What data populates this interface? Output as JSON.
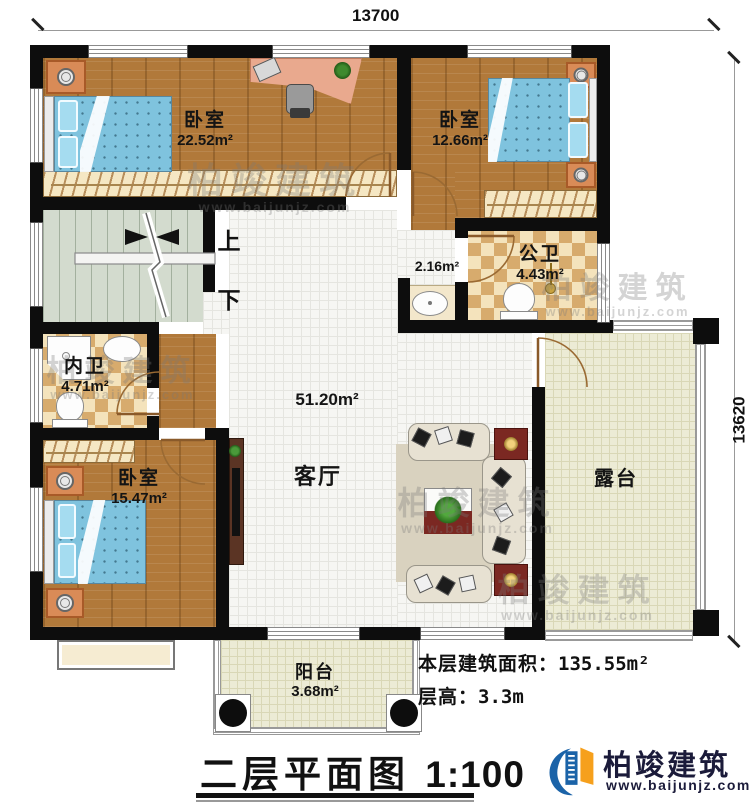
{
  "dimensions": {
    "top_width": "13700",
    "right_height": "13620"
  },
  "rooms": {
    "bedroom_top_left": {
      "name": "卧室",
      "area": "22.52m²"
    },
    "bedroom_top_right": {
      "name": "卧室",
      "area": "12.66m²"
    },
    "public_bathroom": {
      "name": "公卫",
      "area": "4.43m²"
    },
    "wash_area": {
      "area": "2.16m²"
    },
    "private_bathroom": {
      "name": "内卫",
      "area": "4.71m²"
    },
    "bedroom_bottom_left": {
      "name": "卧室",
      "area": "15.47m²"
    },
    "living_room": {
      "name": "客厅",
      "area": "51.20m²"
    },
    "terrace": {
      "name": "露台"
    },
    "balcony": {
      "name": "阳台",
      "area": "3.68m²"
    }
  },
  "stairs": {
    "up_label": "上",
    "down_label": "下"
  },
  "annotations": {
    "floor_area_label": "本层建筑面积：",
    "floor_area_value": "135.55m²",
    "floor_height_label": "层高：",
    "floor_height_value": "3.3m"
  },
  "title": {
    "text": "二层平面图",
    "scale": "1:100"
  },
  "branding": {
    "company": "柏竣建筑",
    "website": "www.baijunjz.com"
  },
  "colors": {
    "wall": "#0d0d0d",
    "wood": "#b1793a",
    "checker_dark": "#d7ab6d",
    "stair": "#d3dbce",
    "terrace": "#ecebd5",
    "brand_blue": "#1b63a8",
    "brand_orange": "#f6a01c"
  }
}
